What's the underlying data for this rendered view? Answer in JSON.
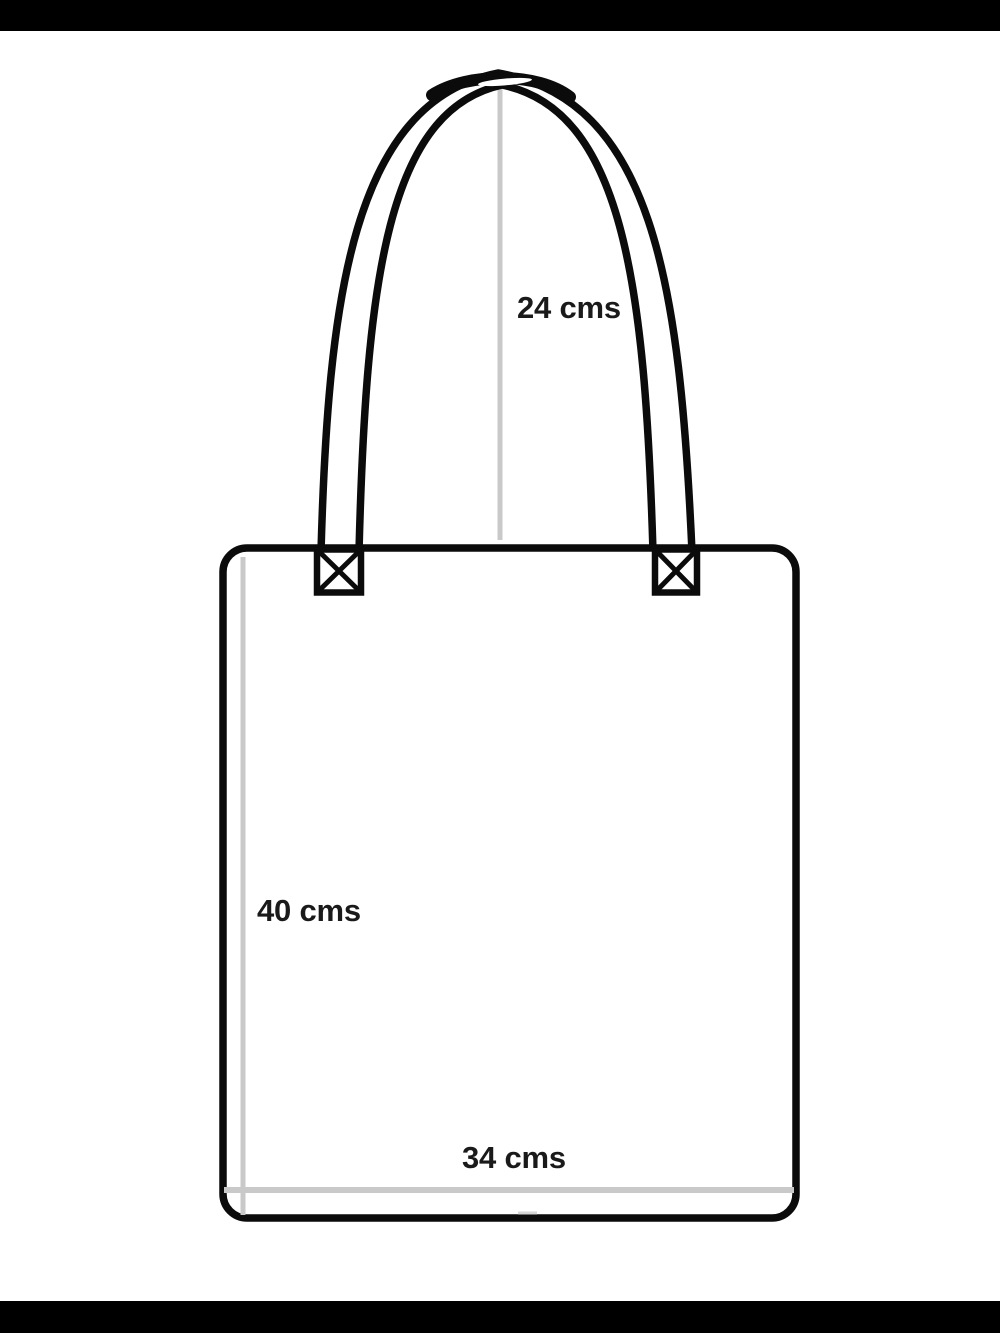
{
  "diagram": {
    "labels": {
      "handle_height": "24 cms",
      "bag_height": "40 cms",
      "bag_width": "34 cms"
    },
    "colors": {
      "outline": "#0b0b0b",
      "guide_line": "#c9c9c9",
      "tick": "#d6d6d6",
      "letterbox": "#000000",
      "background": "#ffffff",
      "label_text": "#1a1a1a"
    }
  }
}
